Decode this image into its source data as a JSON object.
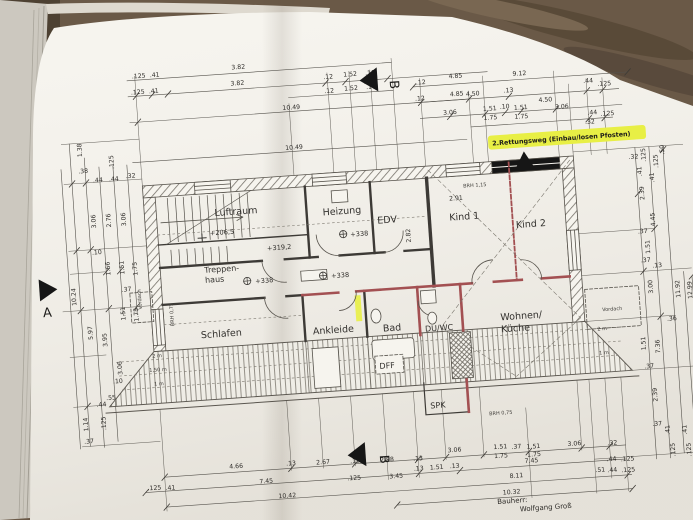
{
  "colors": {
    "cover": "#6a5947",
    "paper": "#f6f4ee",
    "highlight": "#e8ef45",
    "red_wall": "#a35052"
  },
  "note": {
    "text": "2.Rettungsweg (Einbau/losen Pfosten)"
  },
  "markers": {
    "a": "A",
    "b_top": "B",
    "b_bottom": "B"
  },
  "title_block": {
    "label": "Bauherr:",
    "value": "Wolfgang Groß"
  },
  "rooms": {
    "luftraum": "Luftraum",
    "heizung": "Heizung",
    "edv": "EDV",
    "treppenhaus_line1": "Treppen-",
    "treppenhaus_line2": "haus",
    "kind1": "Kind 1",
    "kind2": "Kind 2",
    "schlafen": "Schlafen",
    "ankleide": "Ankleide",
    "bad": "Bad",
    "duwc": "DU/WC",
    "wohnen_line1": "Wohnen/",
    "wohnen_line2": "Küche",
    "spk": "SPK",
    "dff": "DFF"
  },
  "levels": {
    "l206": "+206,5",
    "l319": "+319,2",
    "l338_edv": "+338",
    "l338_hall1": "+338",
    "l338_hall2": "+338"
  },
  "ann": {
    "brh115": "BRH 1,15",
    "brh075_left": "BRH 0,75",
    "brh075_bottom": "BRH 0,75",
    "vordach_left": "Vordach",
    "vordach_right": "Vordach",
    "h2m_left": "2 m",
    "h150_left": "1,50 m",
    "h1m_left": "1 m",
    "h2m_right": "2 m",
    "h1m_right": "1 m",
    "dim_291": "2.91",
    "dim_282": "2.82"
  },
  "dims": {
    "t": [
      ".125",
      ".41",
      "3.82",
      ".125",
      ".41",
      "3.82",
      ".12",
      "1.52",
      ".10",
      "4.85",
      ".12",
      "1.52",
      ".10",
      "10.49",
      "4.85",
      "10.49",
      ".12",
      "9.12",
      ".12",
      "4.50",
      ".13",
      ".44",
      ".125",
      "4.50",
      "3.06",
      "1.51",
      ".10",
      "1.51",
      "3.06",
      "1.75",
      "1.75",
      ".44",
      ".125",
      ".32"
    ],
    "l": [
      "1.38",
      ".38",
      ".125",
      ".44",
      ".44",
      ".32",
      "3.06",
      "2.76",
      "3.06",
      ".10",
      "1.66",
      "1.51",
      "1.75",
      ".37",
      "10.24",
      "1.51",
      "1.75",
      "5.97",
      "3.95",
      "3.06",
      ".10",
      ".55",
      ".44",
      ".125",
      "1.14",
      ".37"
    ],
    "r": [
      ".32",
      ".125",
      ".41",
      ".125",
      ".41",
      ".50",
      "2.39",
      "4.45",
      ".37",
      "1.51",
      ".37",
      ".13",
      "3.00",
      "11.92",
      "12.99",
      ".36",
      "1.51",
      "7.36",
      ".37",
      "2.39",
      ".37",
      ".41",
      ".41",
      ".125",
      ".125",
      ".50"
    ],
    "b": [
      "4.66",
      ".13",
      "2.67",
      ".13",
      "2.88",
      ".13",
      "3.06",
      "1.51",
      ".37",
      "1.51",
      "3.06",
      ".32",
      "1.75",
      "1.75",
      ".125",
      ".41",
      "7.45",
      ".125",
      "3.45",
      ".13",
      "1.51",
      ".13",
      "7.45",
      "10.42",
      "8.11",
      ".51",
      ".44",
      ".125",
      ".44",
      ".125",
      "10.32"
    ]
  }
}
